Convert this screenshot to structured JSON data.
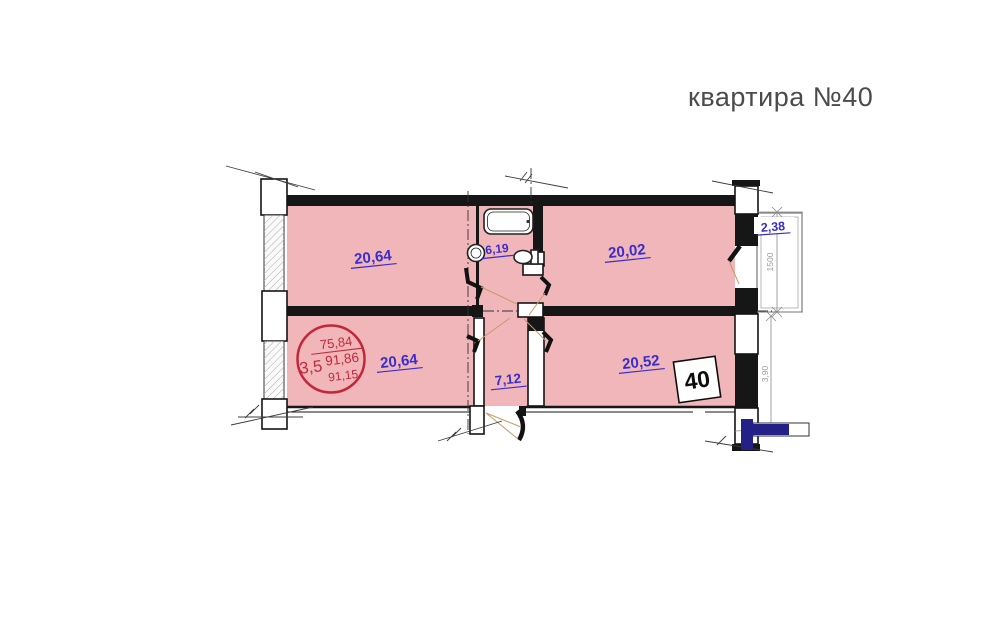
{
  "title": "квартира №40",
  "rooms": {
    "top_left": {
      "area": "20,64"
    },
    "top_right": {
      "area": "20,02"
    },
    "bottom_left": {
      "area": "20,64"
    },
    "bottom_right": {
      "area": "20,52"
    },
    "corridor": {
      "area": "7,12"
    },
    "bathroom": {
      "area": "6,19"
    },
    "balcony": {
      "area": "2,38"
    }
  },
  "stamp": {
    "left_value": "3,5",
    "top_value": "75,84",
    "middle_value": "91,86",
    "bottom_value": "91,15"
  },
  "apartment_number": "40",
  "dimensions": {
    "balcony_width": "1500",
    "right_lower": "3,90"
  },
  "colors": {
    "room_fill": "#f1b6b9",
    "label_blue": "#3a2ecb",
    "stamp_red": "#c1293b",
    "wall": "#161616",
    "navy_highlight": "#232185"
  }
}
